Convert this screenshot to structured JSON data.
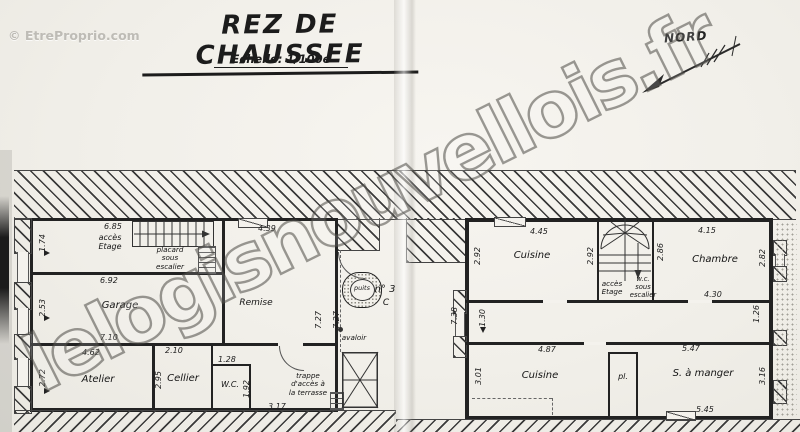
{
  "header": {
    "title": "REZ DE CHAUSSEE",
    "scale": "Echelle: 1/100e"
  },
  "compass": {
    "label": "NORD"
  },
  "watermarks": {
    "diagonal": "lelogisnouvellois.fr",
    "corner": "© EtreProprio.com"
  },
  "courtyard": {
    "well": "puits",
    "drain": "avaloir",
    "number": "n° 3",
    "number_line2": "C",
    "dim_height": "7.27"
  },
  "left_building": {
    "labels": {
      "acces_etage": "accès\nEtage",
      "placard": "placard\nsous\nescalier",
      "garage": "Garage",
      "atelier": "Atelier",
      "cellier": "Cellier",
      "wc": "W.C.",
      "remise": "Remise",
      "trappe": "trappe\nd'accès à\nla terrasse"
    },
    "dims": {
      "hall_w": "6.85",
      "hall_h": "1.74",
      "garage_w": "6.92",
      "garage_h": "2.53",
      "garage_inner_w": "7.10",
      "atelier_w": "4.62",
      "atelier_h": "2.72",
      "cellier_w": "2.10",
      "cellier_h": "2.95",
      "wc_w": "1.28",
      "wc_h": "1.92",
      "terrace_w": "3.17",
      "remise_w": "4.39",
      "remise_h": "7.27"
    }
  },
  "right_building": {
    "labels": {
      "kitchen1": "Cuisine",
      "bedroom": "Chambre",
      "acces_etage": "accès\nEtage",
      "wc_stairs": "w.c.\nsous\nescalier",
      "kitchen2": "Cuisine",
      "closet": "pl.",
      "dining": "S. à manger"
    },
    "dims": {
      "outer_h": "7.38",
      "kitchen1_w": "4.45",
      "kitchen1_hl": "2.92",
      "kitchen1_hr": "2.92",
      "stair_h": "2.86",
      "bedroom_w": "4.15",
      "bedroom_h": "2.82",
      "bedroom_bottom": "4.30",
      "win_left": "1.30",
      "win_right": "1.26",
      "kitchen2_w": "4.87",
      "kitchen2_h": "3.01",
      "dining_w": "5.47",
      "dining_h": "3.16",
      "dining_bottom": "5.45"
    }
  }
}
